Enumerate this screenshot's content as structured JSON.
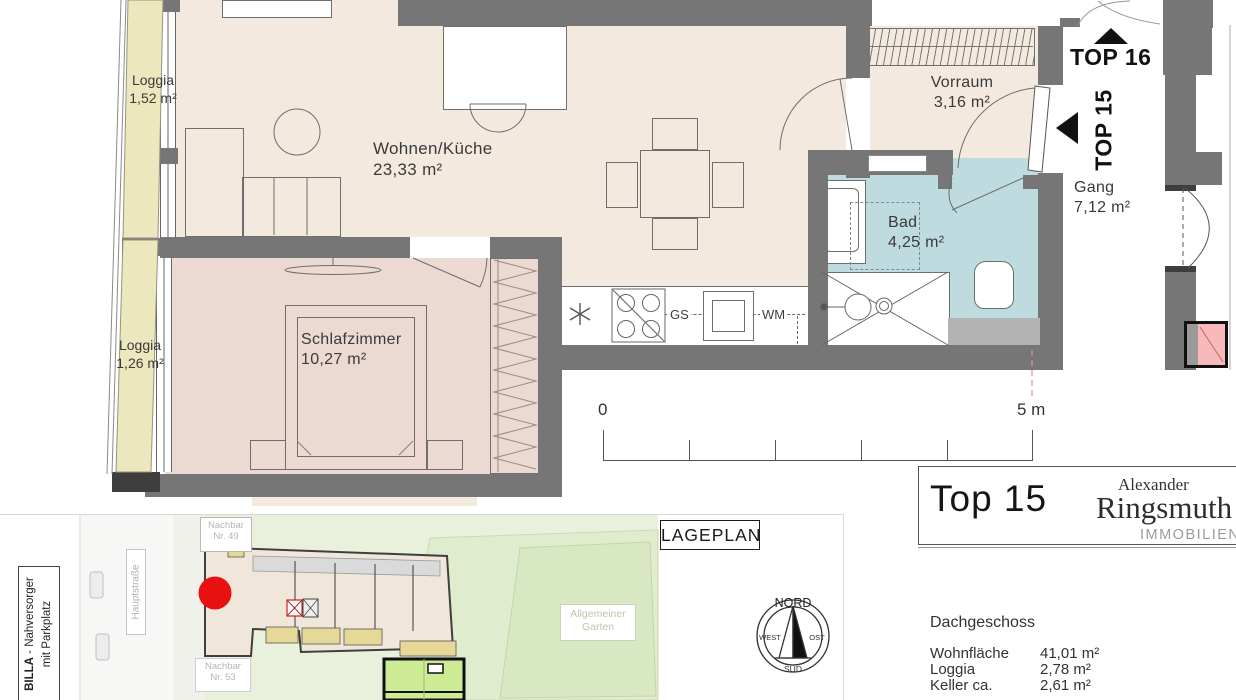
{
  "floorplan": {
    "rooms": {
      "loggia_top": {
        "name": "Loggia",
        "area": "1,52 m²"
      },
      "loggia_bottom": {
        "name": "Loggia",
        "area": "1,26 m²"
      },
      "wohnen": {
        "name": "Wohnen/Küche",
        "area": "23,33 m²"
      },
      "schlafzimmer": {
        "name": "Schlafzimmer",
        "area": "10,27 m²"
      },
      "vorraum": {
        "name": "Vorraum",
        "area": "3,16 m²"
      },
      "bad": {
        "name": "Bad",
        "area": "4,25 m²"
      },
      "gang": {
        "name": "Gang",
        "area": "7,12 m²"
      }
    },
    "unit_labels": {
      "top16": "TOP 16",
      "top15": "TOP 15"
    },
    "kitchen": {
      "dishwasher": "GS",
      "washer": "WM"
    },
    "scale_bar": {
      "start": "0",
      "end": "5 m"
    },
    "colors": {
      "wall": "#767676",
      "living": "#f3e9df",
      "bedroom": "#ecd9d1",
      "bath": "#bedbdf",
      "loggia": "#ece7bd",
      "marker_red": "#e81111",
      "highlight_pink": "#f7b9b9"
    }
  },
  "siteplan": {
    "title": "LAGEPLAN",
    "billa": {
      "bold": "BILLA",
      "rest": " - Nahversorger",
      "line2": "mit Parkplatz"
    },
    "street": "Hauptstraße",
    "neighbor_49": {
      "line1": "Nachbar",
      "line2": "Nr. 49"
    },
    "neighbor_53": {
      "line1": "Nachbar",
      "line2": "Nr. 53"
    },
    "garden": {
      "line1": "Allgemeiner",
      "line2": "Garten"
    },
    "compass": {
      "north": "NORD",
      "west": "WEST",
      "east": "OST",
      "south": "SÜD"
    }
  },
  "info_panel": {
    "unit_title": "Top 15",
    "logo": {
      "first_name": "Alexander",
      "last_name": "Ringsmuth",
      "subtitle": "IMMOBILIEN",
      "accent_color": "#8c2f2a"
    },
    "floor_label": "Dachgeschoss",
    "details": [
      {
        "label": "Wohnfläche",
        "value": "41,01 m²"
      },
      {
        "label": "Loggia",
        "value": "2,78 m²"
      },
      {
        "label": "Keller ca.",
        "value": "2,61 m²"
      }
    ]
  }
}
